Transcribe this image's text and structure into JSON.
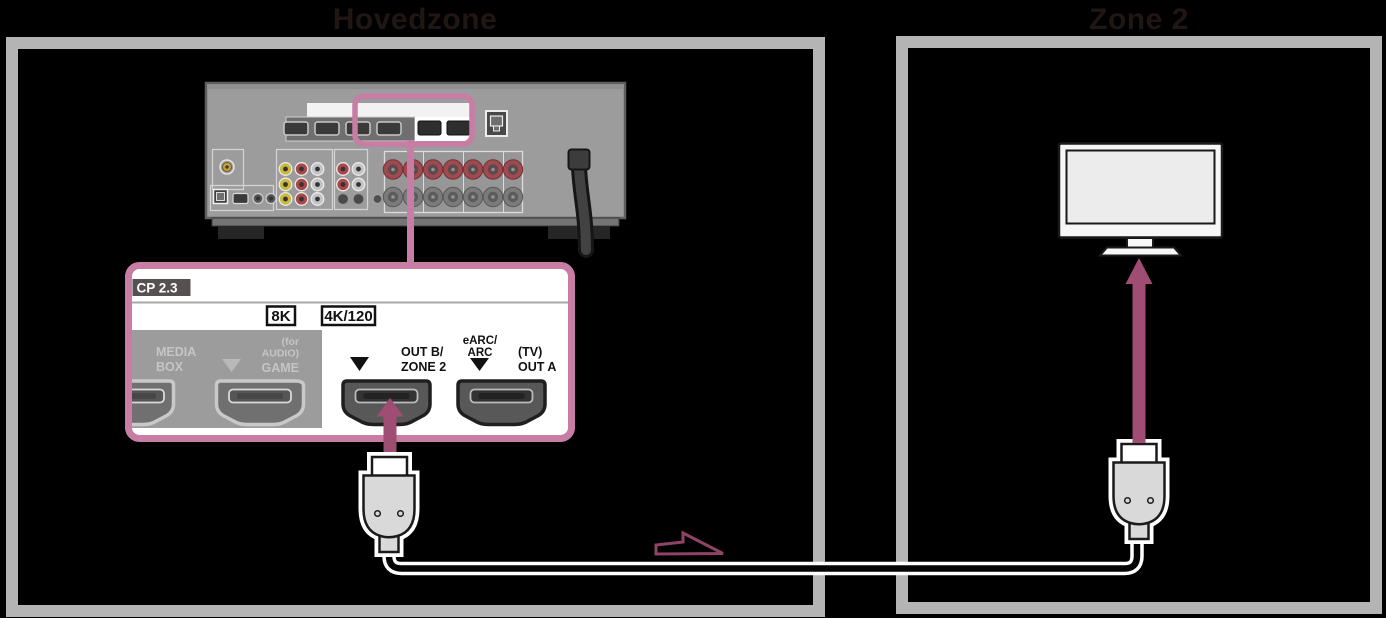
{
  "zones": {
    "main": "Hovedzone",
    "second": "Zone 2"
  },
  "callout": {
    "copy_protection": "CP 2.3",
    "badge_8k": "8K",
    "badge_4k120": "4K/120",
    "ports": {
      "media_box": {
        "line1": "MEDIA",
        "line2": "BOX"
      },
      "game": {
        "line1": "(for",
        "line2": "AUDIO)",
        "line3": "GAME"
      },
      "out_b": {
        "line1": "OUT B/",
        "line2": "ZONE 2"
      },
      "earc": {
        "line1": "eARC/",
        "line2": "ARC"
      },
      "out_a": {
        "line1": "(TV)",
        "line2": "OUT A"
      }
    }
  },
  "colors": {
    "background": "#000000",
    "zone_frame_gray": "#b4b4b4",
    "zone_label_text": "#201613",
    "highlight_pink": "#c77da4",
    "arrow_pink": "#9f4d73",
    "direction_arrow_outline": "#8e4466",
    "receiver_body_gray": "#9c9c9c",
    "connector_gray": "#d9d9d9"
  }
}
